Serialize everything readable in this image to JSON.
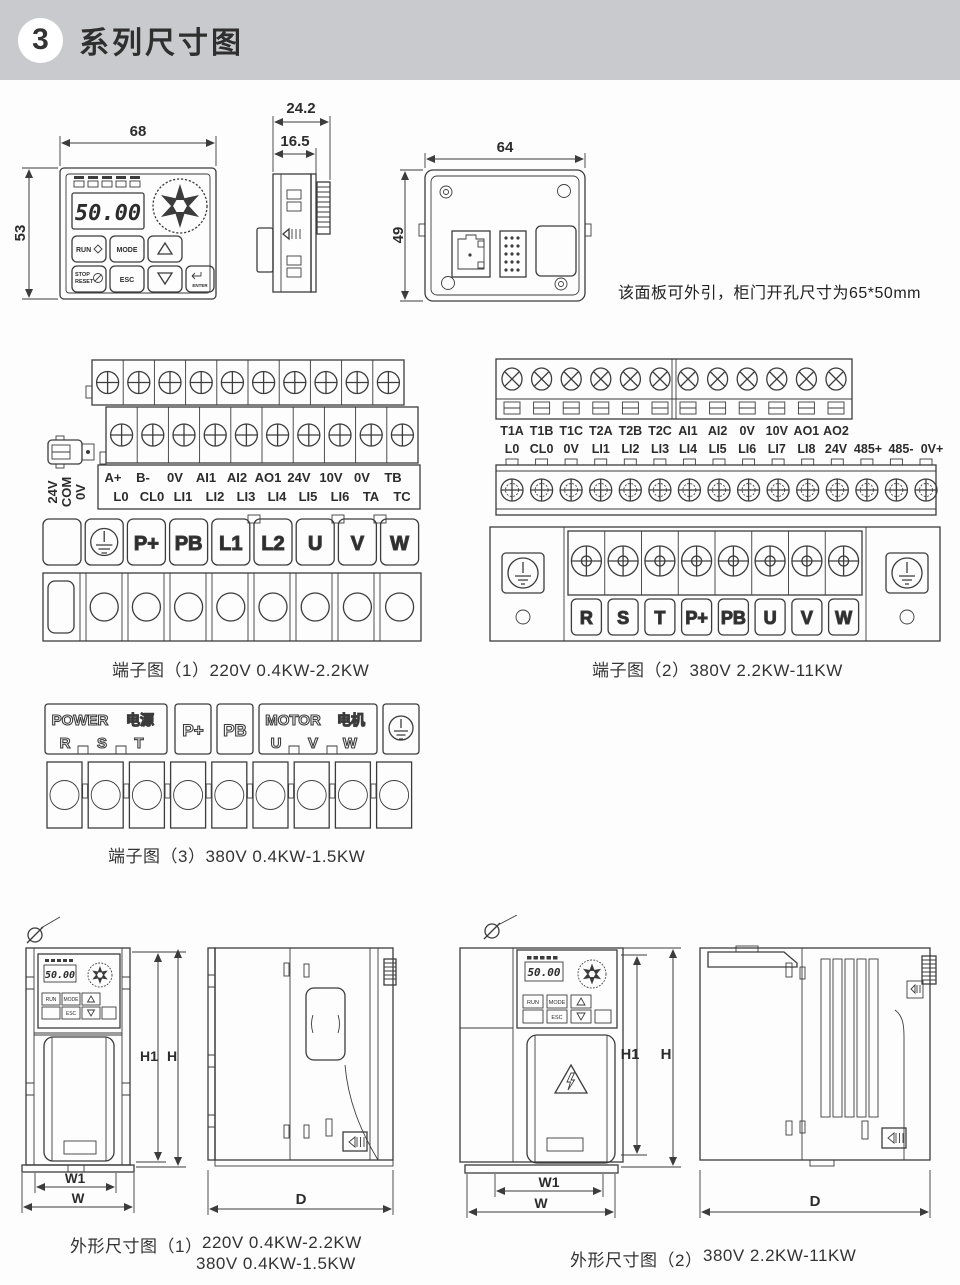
{
  "header": {
    "number": "3",
    "title": "系列尺寸图"
  },
  "colors": {
    "header_bg": "#c9cacd",
    "line": "#3c3c3c",
    "text": "#2c2c2c"
  },
  "panel": {
    "front": {
      "width_dim": "68",
      "height_dim": "53",
      "display": "50.00",
      "buttons": {
        "run": "RUN",
        "mode": "MODE",
        "stop": "STOP",
        "reset": "RESET",
        "esc": "ESC",
        "enter": "ENTER"
      }
    },
    "side": {
      "depth_dim": "24.2",
      "inner_depth_dim": "16.5"
    },
    "back": {
      "width_dim": "64",
      "height_dim": "49"
    },
    "note": "该面板可外引，柜门开孔尺寸为65*50mm"
  },
  "terminal1": {
    "caption": "端子图（1）220V 0.4KW-2.2KW",
    "row1": [
      "A+",
      "B-",
      "0V",
      "AI1",
      "AI2",
      "AO1",
      "24V",
      "10V",
      "0V",
      "TB"
    ],
    "row2": [
      "L0",
      "CL0",
      "LI1",
      "LI2",
      "LI3",
      "LI4",
      "LI5",
      "LI6",
      "TA",
      "TC"
    ],
    "side_labels": [
      "24V",
      "COM",
      "0V"
    ],
    "power": [
      "P+",
      "PB",
      "L1",
      "L2",
      "U",
      "V",
      "W"
    ]
  },
  "terminal2": {
    "caption": "端子图（2）380V 2.2KW-11KW",
    "row1": [
      "T1A",
      "T1B",
      "T1C",
      "T2A",
      "T2B",
      "T2C",
      "AI1",
      "AI2",
      "0V",
      "10V",
      "AO1",
      "AO2"
    ],
    "row2": [
      "L0",
      "CL0",
      "0V",
      "LI1",
      "LI2",
      "LI3",
      "LI4",
      "LI5",
      "LI6",
      "LI7",
      "LI8",
      "24V",
      "485+",
      "485-",
      "0V+"
    ],
    "power": [
      "R",
      "S",
      "T",
      "P+",
      "PB",
      "U",
      "V",
      "W"
    ]
  },
  "terminal3": {
    "caption": "端子图（3）380V 0.4KW-1.5KW",
    "power_en": "POWER",
    "power_cn": "电源",
    "power_terms": [
      "R",
      "S",
      "T"
    ],
    "brake": [
      "P+",
      "PB"
    ],
    "motor_en": "MOTOR",
    "motor_cn": "电机",
    "motor_terms": [
      "U",
      "V",
      "W"
    ]
  },
  "outline1": {
    "caption": "外形尺寸图（1）",
    "specs": [
      "220V 0.4KW-2.2KW",
      "380V 0.4KW-1.5KW"
    ],
    "dims": {
      "h1": "H1",
      "h": "H",
      "w1": "W1",
      "w": "W",
      "d": "D"
    }
  },
  "outline2": {
    "caption": "外形尺寸图（2）",
    "spec": "380V 2.2KW-11KW",
    "dims": {
      "h1": "H1",
      "h": "H",
      "w1": "W1",
      "w": "W",
      "d": "D"
    }
  }
}
